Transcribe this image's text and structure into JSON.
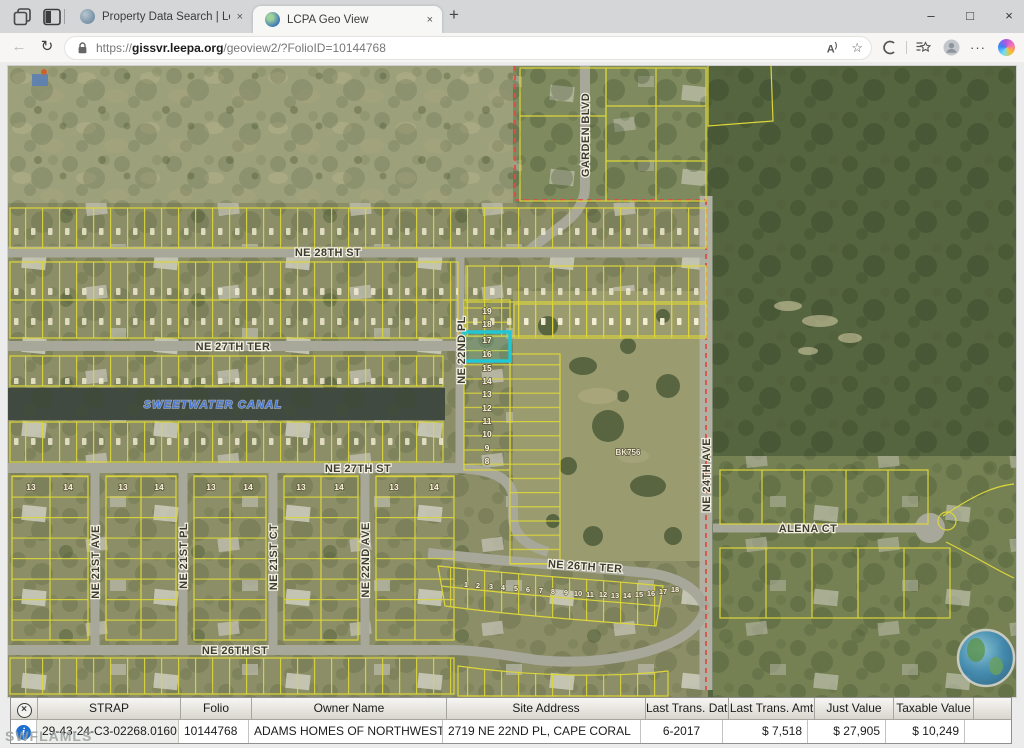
{
  "browser": {
    "tab_bar": {
      "tabs": [
        {
          "title": "Property Data Search | Lee Count"
        },
        {
          "title": "LCPA Geo View"
        }
      ]
    },
    "address_bar": {
      "url_scheme": "https://",
      "url_host": "gissvr.leepa.org",
      "url_path": "/geoview2/?FolioID=10144768"
    },
    "icons": {
      "minimize": "–",
      "maximize": "□",
      "close": "×",
      "back": "←",
      "refresh": "↻",
      "read_aloud": "A",
      "read_aloud_wave": ")",
      "favorite_star": "☆",
      "more": "···",
      "new_tab": "+",
      "tab_close": "×"
    }
  },
  "map": {
    "street_labels": {
      "ne_28th_st": "NE 28TH ST",
      "ne_27th_ter": "NE 27TH TER",
      "ne_27th_st": "NE 27TH ST",
      "ne_26th_ter": "NE 26TH TER",
      "ne_26th_st": "NE 26TH ST",
      "ne_22nd_pl": "NE 22ND PL",
      "ne_22nd_ave": "NE 22ND AVE",
      "ne_21st_ave": "NE 21ST AVE",
      "ne_21st_pl": "NE 21ST PL",
      "ne_21st_ct": "NE 21ST CT",
      "ne_24th_ave": "NE 24TH AVE",
      "garden_blvd": "GARDEN BLVD",
      "alena_ct": "ALENA CT"
    },
    "canal_label": "SWEETWATER CANAL",
    "parcel_block_label": "BK756",
    "lot_column": [
      "19",
      "18",
      "17",
      "16",
      "15",
      "14",
      "13",
      "12",
      "11",
      "10",
      "9",
      "8"
    ],
    "south_block_lots": [
      "13",
      "14"
    ],
    "fan_lots": [
      "1",
      "2",
      "3",
      "4",
      "5",
      "6",
      "7",
      "8",
      "9",
      "10",
      "11",
      "12",
      "13",
      "14",
      "15",
      "16",
      "17",
      "18"
    ],
    "colors": {
      "highlight": "#1fc8d4",
      "parcel_line": "#ddd63a",
      "boundary_line": "#d85045"
    }
  },
  "table": {
    "columns": [
      "STRAP",
      "Folio",
      "Owner Name",
      "Site Address",
      "Last Trans. Date",
      "Last Trans. Amt",
      "Just Value",
      "Taxable Value"
    ],
    "row": {
      "strap": "29-43-24-C3-02268.0160",
      "folio": "10144768",
      "owner": "ADAMS HOMES OF NORTHWEST FLORI",
      "site_address": "2719 NE 22ND PL, CAPE CORAL",
      "last_trans_date": "6-2017",
      "last_trans_amt": "$ 7,518",
      "just_value": "$ 27,905",
      "taxable_value": "$ 10,249"
    },
    "icons": {
      "close": "×",
      "info": "i"
    }
  },
  "watermark": "SWFLAMLS"
}
